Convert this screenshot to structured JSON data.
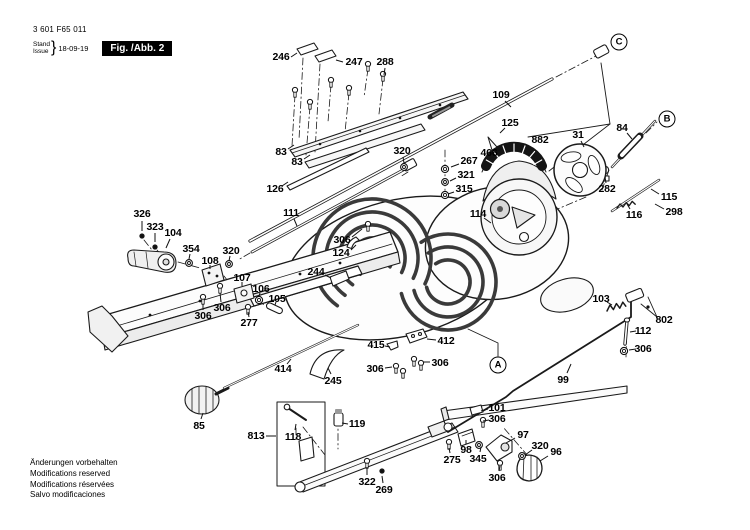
{
  "header": {
    "part_no": "3 601 F65 011",
    "stand_label": "Stand",
    "issue_label": "Issue",
    "brace": "}",
    "date": "18-09-19",
    "figure": "Fig. /Abb. 2"
  },
  "footer": {
    "lines": [
      "Änderungen vorbehalten",
      "Modifications reserved",
      "Modifications réservées",
      "Salvo modificaciones"
    ]
  },
  "diagram": {
    "callouts": [
      {
        "t": "A",
        "x": 498,
        "y": 365
      },
      {
        "t": "B",
        "x": 667,
        "y": 119
      },
      {
        "t": "C",
        "x": 619,
        "y": 42
      }
    ],
    "labels": [
      {
        "t": "246",
        "x": 281,
        "y": 57,
        "lead": [
          291,
          57,
          297,
          53
        ]
      },
      {
        "t": "247",
        "x": 354,
        "y": 62,
        "lead": [
          343,
          62,
          336,
          60
        ]
      },
      {
        "t": "288",
        "x": 385,
        "y": 62,
        "lead": [
          385,
          68,
          384,
          75
        ]
      },
      {
        "t": "109",
        "x": 501,
        "y": 95,
        "lead": [
          505,
          101,
          511,
          107
        ]
      },
      {
        "t": "83",
        "x": 281,
        "y": 152,
        "lead": [
          288,
          149,
          294,
          145
        ]
      },
      {
        "t": "83",
        "x": 297,
        "y": 162,
        "lead": [
          304,
          159,
          310,
          155
        ]
      },
      {
        "t": "126",
        "x": 275,
        "y": 189,
        "lead": [
          282,
          186,
          288,
          182
        ]
      },
      {
        "t": "320",
        "x": 402,
        "y": 151,
        "lead": [
          403,
          157,
          404,
          163
        ]
      },
      {
        "t": "267",
        "x": 469,
        "y": 161,
        "lead": [
          459,
          164,
          451,
          167
        ]
      },
      {
        "t": "321",
        "x": 466,
        "y": 175,
        "lead": [
          456,
          178,
          450,
          181
        ]
      },
      {
        "t": "315",
        "x": 464,
        "y": 189,
        "lead": [
          454,
          192,
          448,
          194
        ]
      },
      {
        "t": "114",
        "x": 478,
        "y": 214,
        "lead": [
          484,
          218,
          491,
          223
        ]
      },
      {
        "t": "111",
        "x": 291,
        "y": 213,
        "lead": [
          294,
          219,
          297,
          226
        ]
      },
      {
        "t": "326",
        "x": 142,
        "y": 214,
        "lead": [
          142,
          221,
          142,
          231
        ]
      },
      {
        "t": "323",
        "x": 155,
        "y": 227,
        "lead": [
          155,
          233,
          155,
          242
        ]
      },
      {
        "t": "104",
        "x": 173,
        "y": 233,
        "lead": [
          170,
          239,
          166,
          248
        ]
      },
      {
        "t": "354",
        "x": 191,
        "y": 249,
        "lead": [
          190,
          254,
          189,
          259
        ]
      },
      {
        "t": "108",
        "x": 210,
        "y": 261,
        "lead": [
          210,
          265,
          210,
          269
        ]
      },
      {
        "t": "320",
        "x": 231,
        "y": 251,
        "lead": [
          230,
          256,
          229,
          261
        ]
      },
      {
        "t": "107",
        "x": 242,
        "y": 278,
        "lead": [
          242,
          282,
          242,
          286
        ]
      },
      {
        "t": "106",
        "x": 261,
        "y": 289,
        "lead": [
          260,
          293,
          259,
          296
        ]
      },
      {
        "t": "105",
        "x": 277,
        "y": 299,
        "lead": [
          276,
          302,
          275,
          305
        ]
      },
      {
        "t": "306",
        "x": 203,
        "y": 316,
        "lead": [
          203,
          310,
          203,
          304
        ]
      },
      {
        "t": "306",
        "x": 222,
        "y": 308,
        "lead": [
          221,
          302,
          220,
          293
        ]
      },
      {
        "t": "277",
        "x": 249,
        "y": 323,
        "lead": [
          249,
          317,
          248,
          312
        ]
      },
      {
        "t": "306",
        "x": 342,
        "y": 240,
        "lead": [
          352,
          237,
          362,
          229
        ]
      },
      {
        "t": "124",
        "x": 341,
        "y": 253,
        "lead": [
          351,
          250,
          356,
          245
        ]
      },
      {
        "t": "244",
        "x": 316,
        "y": 272,
        "lead": [
          325,
          275,
          331,
          278
        ]
      },
      {
        "t": "415",
        "x": 376,
        "y": 345,
        "lead": [
          385,
          346,
          390,
          347
        ]
      },
      {
        "t": "412",
        "x": 446,
        "y": 341,
        "lead": [
          436,
          340,
          427,
          339
        ]
      },
      {
        "t": "306",
        "x": 375,
        "y": 369,
        "lead": [
          385,
          368,
          392,
          367
        ]
      },
      {
        "t": "306",
        "x": 440,
        "y": 363,
        "lead": [
          430,
          362,
          423,
          362
        ]
      },
      {
        "t": "245",
        "x": 333,
        "y": 381,
        "lead": [
          331,
          374,
          328,
          368
        ]
      },
      {
        "t": "414",
        "x": 283,
        "y": 369,
        "lead": [
          287,
          364,
          291,
          359
        ]
      },
      {
        "t": "85",
        "x": 199,
        "y": 426,
        "lead": [
          201,
          419,
          203,
          413
        ]
      },
      {
        "t": "813",
        "x": 256,
        "y": 436,
        "lead": [
          266,
          436,
          276,
          436
        ]
      },
      {
        "t": "118",
        "x": 293,
        "y": 437,
        "lead": [
          295,
          430,
          296,
          424
        ]
      },
      {
        "t": "119",
        "x": 357,
        "y": 424,
        "lead": [
          348,
          424,
          342,
          423
        ]
      },
      {
        "t": "322",
        "x": 367,
        "y": 482,
        "lead": [
          367,
          475,
          367,
          467
        ]
      },
      {
        "t": "269",
        "x": 384,
        "y": 490,
        "lead": [
          383,
          483,
          382,
          476
        ]
      },
      {
        "t": "99",
        "x": 563,
        "y": 380,
        "lead": [
          567,
          373,
          571,
          364
        ]
      },
      {
        "t": "103",
        "x": 601,
        "y": 299,
        "lead": [
          607,
          302,
          612,
          305
        ]
      },
      {
        "t": "802",
        "x": 664,
        "y": 320
      },
      {
        "t": "112",
        "x": 643,
        "y": 331,
        "lead": [
          636,
          331,
          630,
          332
        ]
      },
      {
        "t": "306",
        "x": 643,
        "y": 349,
        "lead": [
          636,
          349,
          629,
          350
        ]
      },
      {
        "t": "101",
        "x": 497,
        "y": 408,
        "lead": [
          488,
          409,
          481,
          411
        ]
      },
      {
        "t": "306",
        "x": 497,
        "y": 419,
        "lead": [
          489,
          420,
          483,
          421
        ]
      },
      {
        "t": "97",
        "x": 523,
        "y": 435,
        "lead": [
          515,
          438,
          506,
          443
        ]
      },
      {
        "t": "320",
        "x": 540,
        "y": 446,
        "lead": [
          532,
          450,
          525,
          455
        ]
      },
      {
        "t": "96",
        "x": 556,
        "y": 452,
        "lead": [
          548,
          456,
          540,
          461
        ]
      },
      {
        "t": "306",
        "x": 497,
        "y": 478,
        "lead": [
          499,
          471,
          500,
          466
        ]
      },
      {
        "t": "275",
        "x": 452,
        "y": 460,
        "lead": [
          450,
          453,
          449,
          448
        ]
      },
      {
        "t": "98",
        "x": 466,
        "y": 450,
        "lead": [
          466,
          444,
          466,
          440
        ]
      },
      {
        "t": "345",
        "x": 478,
        "y": 459,
        "lead": [
          480,
          452,
          481,
          447
        ]
      },
      {
        "t": "282",
        "x": 607,
        "y": 189,
        "lead": [
          606,
          183,
          605,
          177
        ]
      },
      {
        "t": "84",
        "x": 622,
        "y": 128,
        "lead": [
          627,
          133,
          632,
          139
        ]
      },
      {
        "t": "31",
        "x": 578,
        "y": 135,
        "lead": [
          581,
          141,
          584,
          147
        ]
      },
      {
        "t": "115",
        "x": 669,
        "y": 197,
        "lead": [
          659,
          194,
          651,
          189
        ]
      },
      {
        "t": "298",
        "x": 674,
        "y": 212,
        "lead": [
          664,
          209,
          655,
          204
        ]
      },
      {
        "t": "116",
        "x": 634,
        "y": 215,
        "lead": [
          630,
          209,
          627,
          204
        ]
      },
      {
        "t": "882",
        "x": 540,
        "y": 140
      },
      {
        "t": "125",
        "x": 510,
        "y": 123,
        "lead": [
          505,
          128,
          500,
          133
        ]
      },
      {
        "t": "466",
        "x": 489,
        "y": 153,
        "lead": [
          497,
          151,
          503,
          149
        ]
      }
    ]
  }
}
